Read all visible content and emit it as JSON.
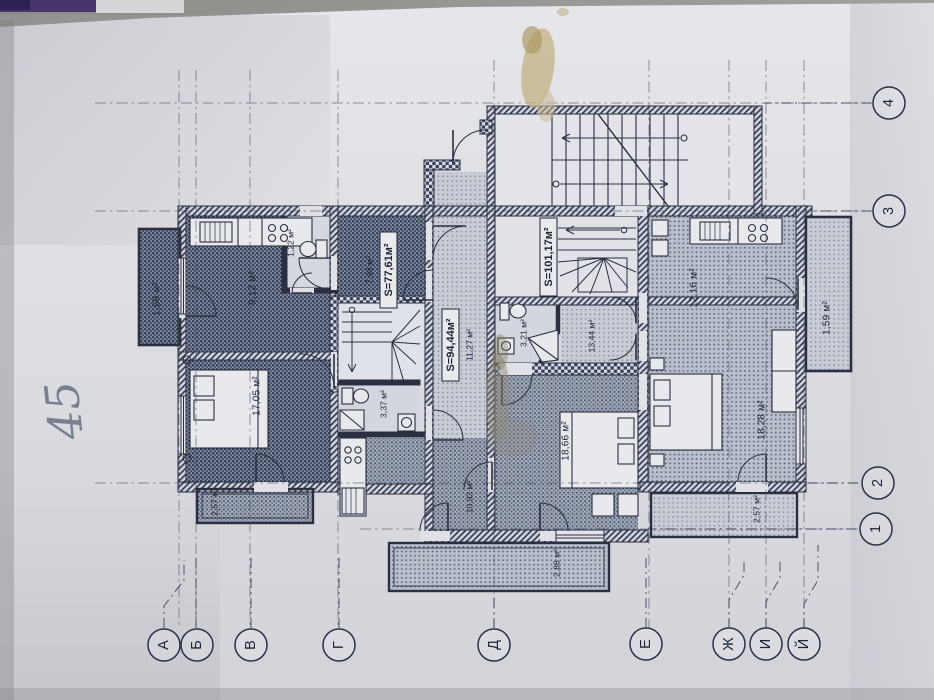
{
  "plan": {
    "apartments": [
      {
        "id": "apartment-1",
        "area_label": "S=77,61м²"
      },
      {
        "id": "apartment-2",
        "area_label": "S=94,44м²"
      },
      {
        "id": "apartment-3",
        "area_label": "S=101,17м²"
      }
    ],
    "rooms": [
      {
        "id": "balcony-left",
        "area": "1,59 м²"
      },
      {
        "id": "kitchen-apt1",
        "area": "9,12 м²"
      },
      {
        "id": "wc-apt1",
        "area": "1,22 м²"
      },
      {
        "id": "hall-apt1",
        "area": "7,98 м²"
      },
      {
        "id": "living-apt1",
        "area": "17,05 м²"
      },
      {
        "id": "balcony-apt1-south",
        "area": "2,57 м²"
      },
      {
        "id": "bath-apt2",
        "area": "3,37 м²"
      },
      {
        "id": "hall-apt2",
        "area": "11,27 м²"
      },
      {
        "id": "room-apt2",
        "area": "10,93 м²"
      },
      {
        "id": "balcony-apt2",
        "area": "2,88 м²"
      },
      {
        "id": "bath-apt3",
        "area": "3,21 м²"
      },
      {
        "id": "hall-apt3",
        "area": "13,44 м²"
      },
      {
        "id": "bedroom1-apt3",
        "area": "18,66 м²"
      },
      {
        "id": "kitchen-apt3",
        "area": "12,16 м²"
      },
      {
        "id": "bedroom2-apt3",
        "area": "18,28 м²"
      },
      {
        "id": "balcony-right",
        "area": "1,59 м²"
      },
      {
        "id": "balcony-apt3-south",
        "area": "2,57 м²"
      }
    ],
    "axes": {
      "letters": [
        "А",
        "Б",
        "В",
        "Г",
        "Д",
        "Е",
        "Ж",
        "И",
        "Й"
      ],
      "numbers": [
        "4",
        "3",
        "2",
        "1"
      ]
    },
    "handwritten_note": "45"
  }
}
